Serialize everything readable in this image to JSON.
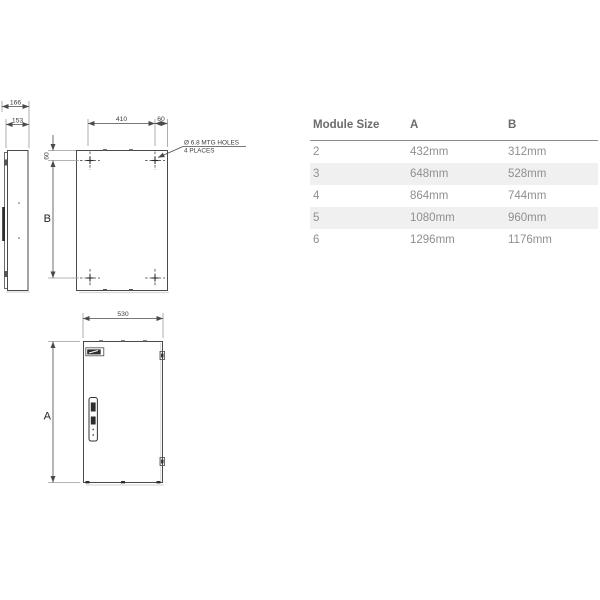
{
  "drawing": {
    "side_view": {
      "overall_depth": "166",
      "body_depth": "153"
    },
    "rear_view": {
      "hole_spacing_h": "410",
      "hole_offset_right": "60",
      "hole_offset_top": "60",
      "height_label": "B",
      "callout": {
        "line1": "Ø 6.8 MTG HOLES",
        "line2": "4 PLACES"
      }
    },
    "front_view": {
      "width": "530",
      "height_label": "A"
    }
  },
  "table": {
    "headers": [
      "Module Size",
      "A",
      "B"
    ],
    "rows": [
      [
        "2",
        "432mm",
        "312mm"
      ],
      [
        "3",
        "648mm",
        "528mm"
      ],
      [
        "4",
        "864mm",
        "744mm"
      ],
      [
        "5",
        "1080mm",
        "960mm"
      ],
      [
        "6",
        "1296mm",
        "1176mm"
      ]
    ]
  },
  "colors": {
    "row_alt_bg": "#f0f0f0",
    "header_text": "#6b6b6b",
    "cell_text": "#8f8f8f",
    "header_rule": "#8a8a8a",
    "drawing_line": "#4a4a4a"
  }
}
